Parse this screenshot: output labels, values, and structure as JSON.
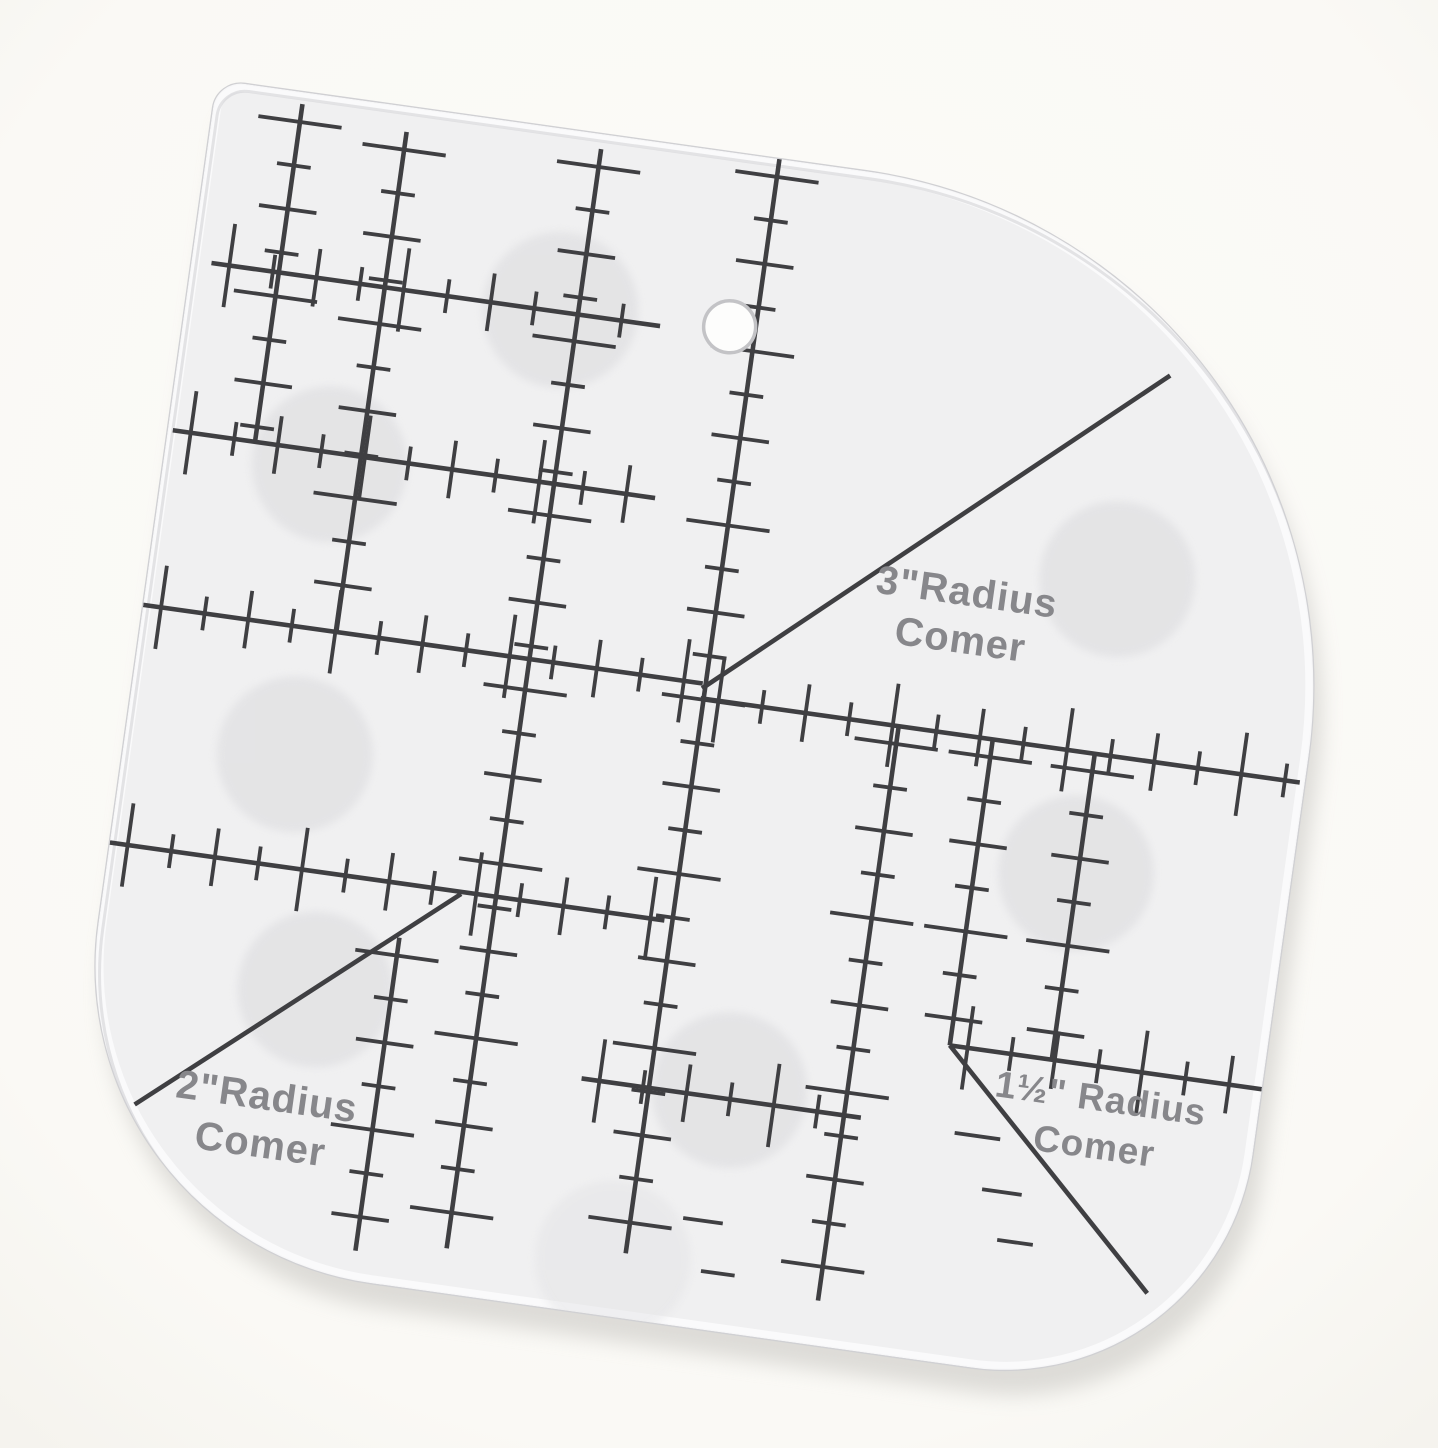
{
  "scene": {
    "kind": "product-photo",
    "subject": "transparent acrylic radius corner template ruler",
    "background_color": "#fbfaf7",
    "background_edge_color": "#f6f4ef"
  },
  "template": {
    "fill_color": "#f0f0f1",
    "edge_color": "#d0d0d3",
    "bevel_color": "#fbfbfc",
    "shadow_color": "#b5b3af",
    "line_color": "#3f3f42",
    "pad_color": "#e2e2e4",
    "text_color": "#87878b",
    "rotation_deg": 8,
    "origin_x": 217,
    "origin_y": 80,
    "width": 1175,
    "height": 1170,
    "corner_radii": {
      "tl": 28,
      "tr": 520,
      "br": 250,
      "bl": 320
    },
    "hole": {
      "u": 542,
      "v": 173,
      "r": 26
    },
    "pad_radius": 78,
    "pads": [
      {
        "u": 372,
        "v": 180,
        "faint": false
      },
      {
        "u": 165,
        "v": 365,
        "faint": false
      },
      {
        "u": 171,
        "v": 657,
        "faint": false
      },
      {
        "u": 224,
        "v": 887,
        "faint": false
      },
      {
        "u": 648,
        "v": 929,
        "faint": false
      },
      {
        "u": 961,
        "v": 666,
        "faint": false
      },
      {
        "u": 961,
        "v": 369,
        "faint": false
      },
      {
        "u": 556,
        "v": 1112,
        "faint": true
      }
    ],
    "labels": [
      {
        "line1": "3\"Radius",
        "line2": "Comer",
        "u": 814,
        "v": 416,
        "size": 40
      },
      {
        "line1": "2\"Radius",
        "line2": "Comer",
        "u": 191,
        "v": 1013,
        "size": 40
      },
      {
        "line1": "1½\" Radius",
        "line2": "Comer",
        "u": 1017,
        "v": 898,
        "size": 37
      }
    ],
    "rulers": [
      {
        "o": "v",
        "c": 88,
        "from": 12,
        "to": 353,
        "ticks": true
      },
      {
        "o": "v",
        "c": 195,
        "from": 25,
        "to": 530,
        "ticks": true
      },
      {
        "o": "v",
        "c": 390,
        "from": 15,
        "to": 1125,
        "ticks": true
      },
      {
        "o": "v",
        "c": 568,
        "from": 0,
        "to": 1105,
        "ticks": true
      },
      {
        "o": "h",
        "c": 182,
        "from": 20,
        "to": 473,
        "ticks": true
      },
      {
        "o": "h",
        "c": 353,
        "from": 5,
        "to": 492,
        "ticks": true
      },
      {
        "o": "h",
        "c": 530,
        "from": 0,
        "to": 565,
        "ticks": true
      },
      {
        "o": "h",
        "c": 770,
        "from": 0,
        "to": 560,
        "ticks": true
      },
      {
        "o": "h",
        "c": 938,
        "from": 500,
        "to": 782,
        "ticks": true
      },
      {
        "o": "h",
        "c": 545,
        "from": 565,
        "to": 1170,
        "ticks": true
      },
      {
        "o": "v",
        "c": 765,
        "from": 545,
        "to": 1125,
        "ticks": true
      },
      {
        "o": "v",
        "c": 963,
        "from": 545,
        "to": 854,
        "ticks": true
      },
      {
        "o": "v",
        "c": 860,
        "from": 545,
        "to": 854,
        "ticks": true
      },
      {
        "o": "h",
        "c": 854,
        "from": 860,
        "to": 1175,
        "ticks": true
      },
      {
        "o": "v",
        "c": 300,
        "from": 824,
        "to": 1140,
        "ticks": true
      }
    ],
    "diagonals": [
      {
        "x1": 565,
        "y1": 535,
        "x2": 985,
        "y2": 160
      },
      {
        "x1": 355,
        "y1": 772,
        "x2": 61,
        "y2": 1026
      },
      {
        "x1": 860,
        "y1": 854,
        "x2": 1090,
        "y2": 1072
      }
    ],
    "extra_ticks": [
      {
        "x": 900,
        "y": 940,
        "len": 46,
        "o": "h"
      },
      {
        "x": 932,
        "y": 992,
        "len": 40,
        "o": "h"
      },
      {
        "x": 952,
        "y": 1040,
        "len": 36,
        "o": "h"
      },
      {
        "x": 640,
        "y": 1062,
        "len": 40,
        "o": "h"
      },
      {
        "x": 662,
        "y": 1112,
        "len": 34,
        "o": "h"
      }
    ],
    "tick_spacing": 44,
    "tick_lengths": {
      "xl": 84,
      "long": 58,
      "short": 34
    },
    "line_width": 4.6,
    "tick_width": 3.8
  }
}
